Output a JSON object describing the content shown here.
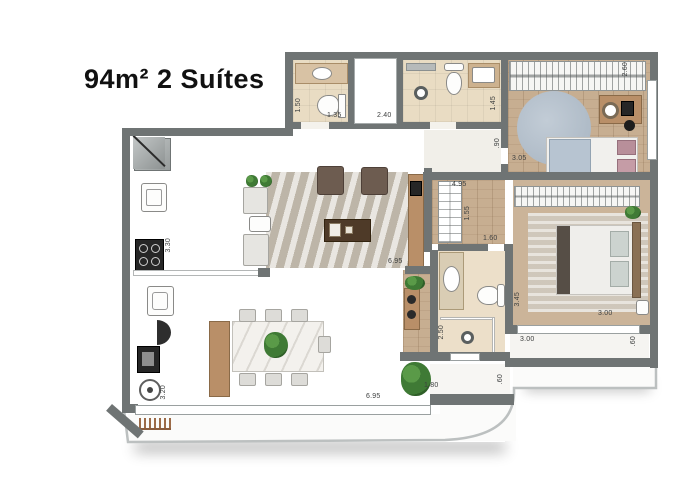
{
  "title": "94m² 2 Suítes",
  "dimensions": {
    "bath1_height": "1.50",
    "bath1_width": "1.35",
    "bath2_width": "2.40",
    "bath2_height": "1.45",
    "suite2_depth": "2.60",
    "suite2_width": "3.05",
    "hall_width": ".90",
    "closet_span": "4.95",
    "closet_depth": "1.55",
    "bath3_width": "1.60",
    "living_length": "6.95",
    "kitchen_length": "3.30",
    "bath3_length": "2.50",
    "suite1_length": "3.45",
    "suite1_width": "3.00",
    "terrace1_width": "3.00",
    "terrace1_depth": ".60",
    "terrace2_width": "1.80",
    "terrace2_depth": ".60",
    "balcony_length": "6.95",
    "dining_length": "3.20"
  },
  "colors": {
    "wall": "#6f7474",
    "parapet": "#b9bdbd",
    "wood_floor": "#c7ae91",
    "tile_floor": "#edebe7",
    "bath_floor": "#e9dcc3",
    "round_rug": "#b1bdc8",
    "plant_green": "#3f7a35",
    "background": "#ffffff"
  }
}
